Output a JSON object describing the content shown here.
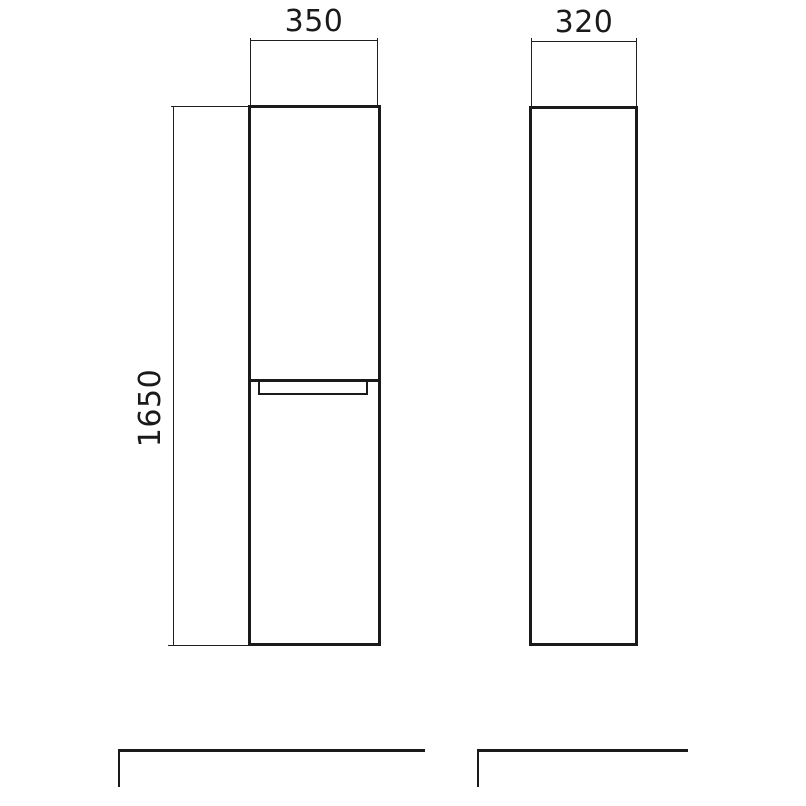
{
  "drawing": {
    "type": "cabinet-dimension-drawing",
    "front_view": {
      "width_label": "350",
      "height_label": "1650"
    },
    "side_view": {
      "depth_label": "320"
    },
    "units_shown": "mm-implied",
    "colors": {
      "line": "#1a1a1a",
      "background": "#ffffff"
    }
  }
}
